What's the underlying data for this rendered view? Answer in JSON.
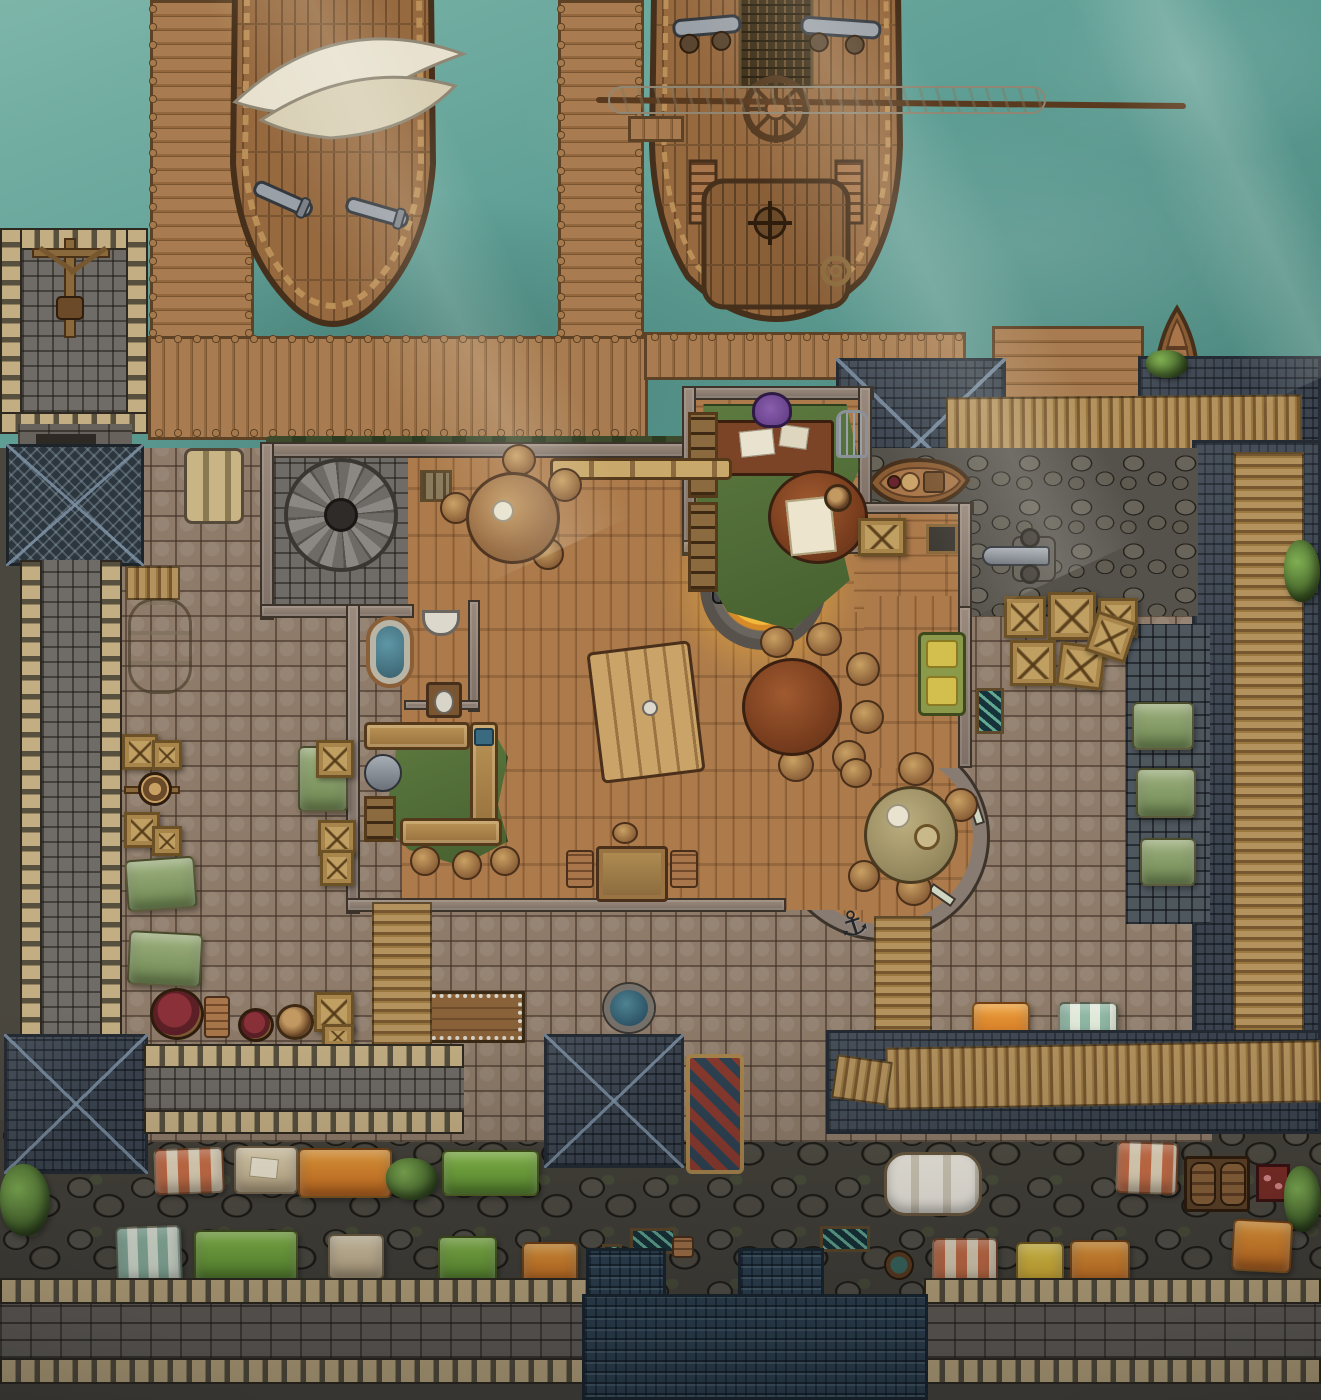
{
  "scene": {
    "type": "ttrpg-battlemap",
    "title": "Dockside smugglers' tavern with harbor, ships, walled courtyard and market street",
    "canvas": {
      "width": 1321,
      "height": 1400
    },
    "icons": {
      "anchor": "⚓"
    },
    "palette": {
      "water": "#5f9f95",
      "water_light": "#7db5a9",
      "water_deep": "#4b867d",
      "dock_wood": "#a87c50",
      "dock_dark": "#7a5531",
      "ship_wood": "#96693f",
      "hull_trim": "#46301b",
      "sail": "#e8e1cf",
      "floor_wood": "#ad7b4b",
      "floor_dark": "#8a5e36",
      "wall": "#8a8078",
      "wall_dark": "#3c332b",
      "cobble": "#8e7b69",
      "rough": "#55524b",
      "slate": "#3a434e",
      "bluetile": "#2e4252",
      "crenel": "#c3ae83",
      "crenel_gap": "#57503f",
      "brick": "#67625c",
      "scaffold": "#b3925d",
      "scaffold_dark": "#77572f",
      "tent_orange": "#e08428",
      "tent_green": "#7fb843",
      "tent_sage": "#8aa06a",
      "tent_yellow": "#e8c83c",
      "stripe_red": "#cd7148",
      "stripe_teal": "#8fb7a4",
      "canvas_cream": "#e7d9bd",
      "tent_tan": "#dbcba6",
      "rug_green": "#5d7a40",
      "fire_glow": "#f2b93c",
      "fire_core": "#e07818",
      "table_dark": "#6b4226",
      "table_tan": "#b08d52",
      "couch_green": "#8a9a4a",
      "wine": "#5c1f26",
      "basin_blue": "#3a6a80",
      "grass": "#5a7a3c",
      "metal": "#7d838a"
    },
    "features": [
      {
        "name": "harbor-water",
        "label": "teal harbor water with light rays"
      },
      {
        "name": "west-pier",
        "label": "vertical plank pier, top left"
      },
      {
        "name": "central-pier",
        "label": "vertical plank pier, top middle"
      },
      {
        "name": "harbor-boardwalk",
        "label": "horizontal boardwalk joining piers to shore"
      },
      {
        "name": "loading-platform",
        "label": "plank platform, top right"
      },
      {
        "name": "ship-sloop",
        "label": "small ship with white double awning and two cannons"
      },
      {
        "name": "ship-merchant",
        "label": "large ship with furled sail yard, ship's wheel, deck guns, stern stairs"
      },
      {
        "name": "rowboat-moored",
        "label": "rowboat tied at north-east platform"
      },
      {
        "name": "rowboat-ashore",
        "label": "loaded rowboat resting on stones east of office"
      },
      {
        "name": "nw-tower",
        "label": "crenellated stone tower with wooden crane"
      },
      {
        "name": "gate-passage",
        "label": "stone passage with net-covered roof below tower"
      },
      {
        "name": "west-rampart",
        "label": "long crenellated wall walkway on the west side"
      },
      {
        "name": "hanging-sacks",
        "label": "grain sacks hung by the boardwalk"
      },
      {
        "name": "tavern-main-hall",
        "label": "large wooden-floor hall"
      },
      {
        "name": "office",
        "label": "office with desk, purple chair, green rug, bookshelves, map table, birdcage"
      },
      {
        "name": "hearth-firepit",
        "label": "round glowing fire pit in stone ring with iron grate"
      },
      {
        "name": "spiral-staircase",
        "label": "stone spiral stair room, north-west of hall"
      },
      {
        "name": "bathroom",
        "label": "bathtub, wall sink and latrine"
      },
      {
        "name": "kitchen-bar",
        "label": "L-shaped counters, stools, torn green rug, pot and basin"
      },
      {
        "name": "storage-room",
        "label": "small store room with crate and wall box"
      },
      {
        "name": "lounge-couch",
        "label": "green couch with yellow cushions on east wall"
      },
      {
        "name": "bay-alcove",
        "label": "round bay window alcove with worn round table"
      },
      {
        "name": "plank-table",
        "label": "big tilted plank table, hall centre"
      },
      {
        "name": "round-table-north",
        "label": "round table with stools near north wall"
      },
      {
        "name": "round-dark-table",
        "label": "dark round table with six stools"
      },
      {
        "name": "card-table",
        "label": "small square table with two chairs, south hall"
      },
      {
        "name": "wall-bench",
        "label": "bench along north wall"
      },
      {
        "name": "courtyard",
        "label": "cobblestone yard around the tavern"
      },
      {
        "name": "crate-stacks",
        "label": "wooden crate stacks along west wall and north-east corner"
      },
      {
        "name": "windlass",
        "label": "rope windlass between crates, west yard"
      },
      {
        "name": "green-tarps",
        "label": "sage tarped stalls in west yard"
      },
      {
        "name": "wine-vat",
        "label": "open vat of dark red wine with chair"
      },
      {
        "name": "barrels",
        "label": "wooden barrels, south-west yard"
      },
      {
        "name": "water-basin",
        "label": "round blue water basin south of tavern"
      },
      {
        "name": "stud-cart",
        "label": "studded wooden cart table"
      },
      {
        "name": "scaffold-walkways",
        "label": "stick scaffold paths, ladders and rooftop bridges"
      },
      {
        "name": "anchor",
        "label": "iron anchor dropped by the bay"
      },
      {
        "name": "ne-cannon",
        "label": "cannon on rough stones, north-east block"
      },
      {
        "name": "fish-crates",
        "label": "teal crates and tables of fresh fish"
      },
      {
        "name": "market-tents-green",
        "label": "three green market tents, east lane"
      },
      {
        "name": "slate-roofs",
        "label": "blue-grey tiled roofs ringing the compound"
      },
      {
        "name": "palisade-walkway",
        "label": "rough palisade fence across north-east roof"
      },
      {
        "name": "sw-pyramid-roof",
        "label": "hipped slate roof, south-west"
      },
      {
        "name": "south-rampart",
        "label": "crenellated walkway along the market row"
      },
      {
        "name": "painted-cart",
        "label": "patterned pedlar cart on south walk"
      },
      {
        "name": "blue-shingle-hall",
        "label": "large dark-blue shingled roof, bottom centre"
      },
      {
        "name": "market-row-upper",
        "label": "striped, tan, orange and green canopies hanging off the rampart"
      },
      {
        "name": "market-row-lower",
        "label": "teal-striped, green, tan, orange and yellow stalls on the street"
      },
      {
        "name": "covered-wagon",
        "label": "white canvas covered wagon"
      },
      {
        "name": "barrel-cart",
        "label": "cart carrying two barrels"
      },
      {
        "name": "butcher-stand",
        "label": "small red meat stand"
      },
      {
        "name": "bushes",
        "label": "green shrubs at street and roof edges"
      },
      {
        "name": "south-wall",
        "label": "bottom fortification wall with twin crenel rows"
      }
    ]
  }
}
